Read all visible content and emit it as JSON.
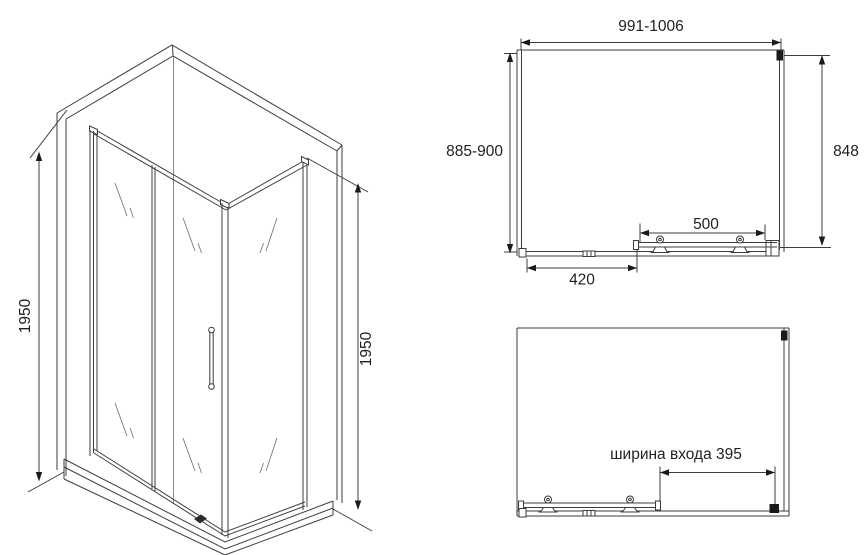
{
  "views": {
    "isometric": {
      "height_left": "1950",
      "height_right": "1950"
    },
    "plan_closed": {
      "width": "991-1006",
      "depth": "885-900",
      "side": "848",
      "door": "500",
      "fixed_panel": "420"
    },
    "plan_open": {
      "entrance": "ширина входа 395"
    }
  },
  "colors": {
    "line": "#3d3d3d",
    "text": "#1f1f1f",
    "accent_fill": "#1a1a1a",
    "background": "#ffffff"
  }
}
